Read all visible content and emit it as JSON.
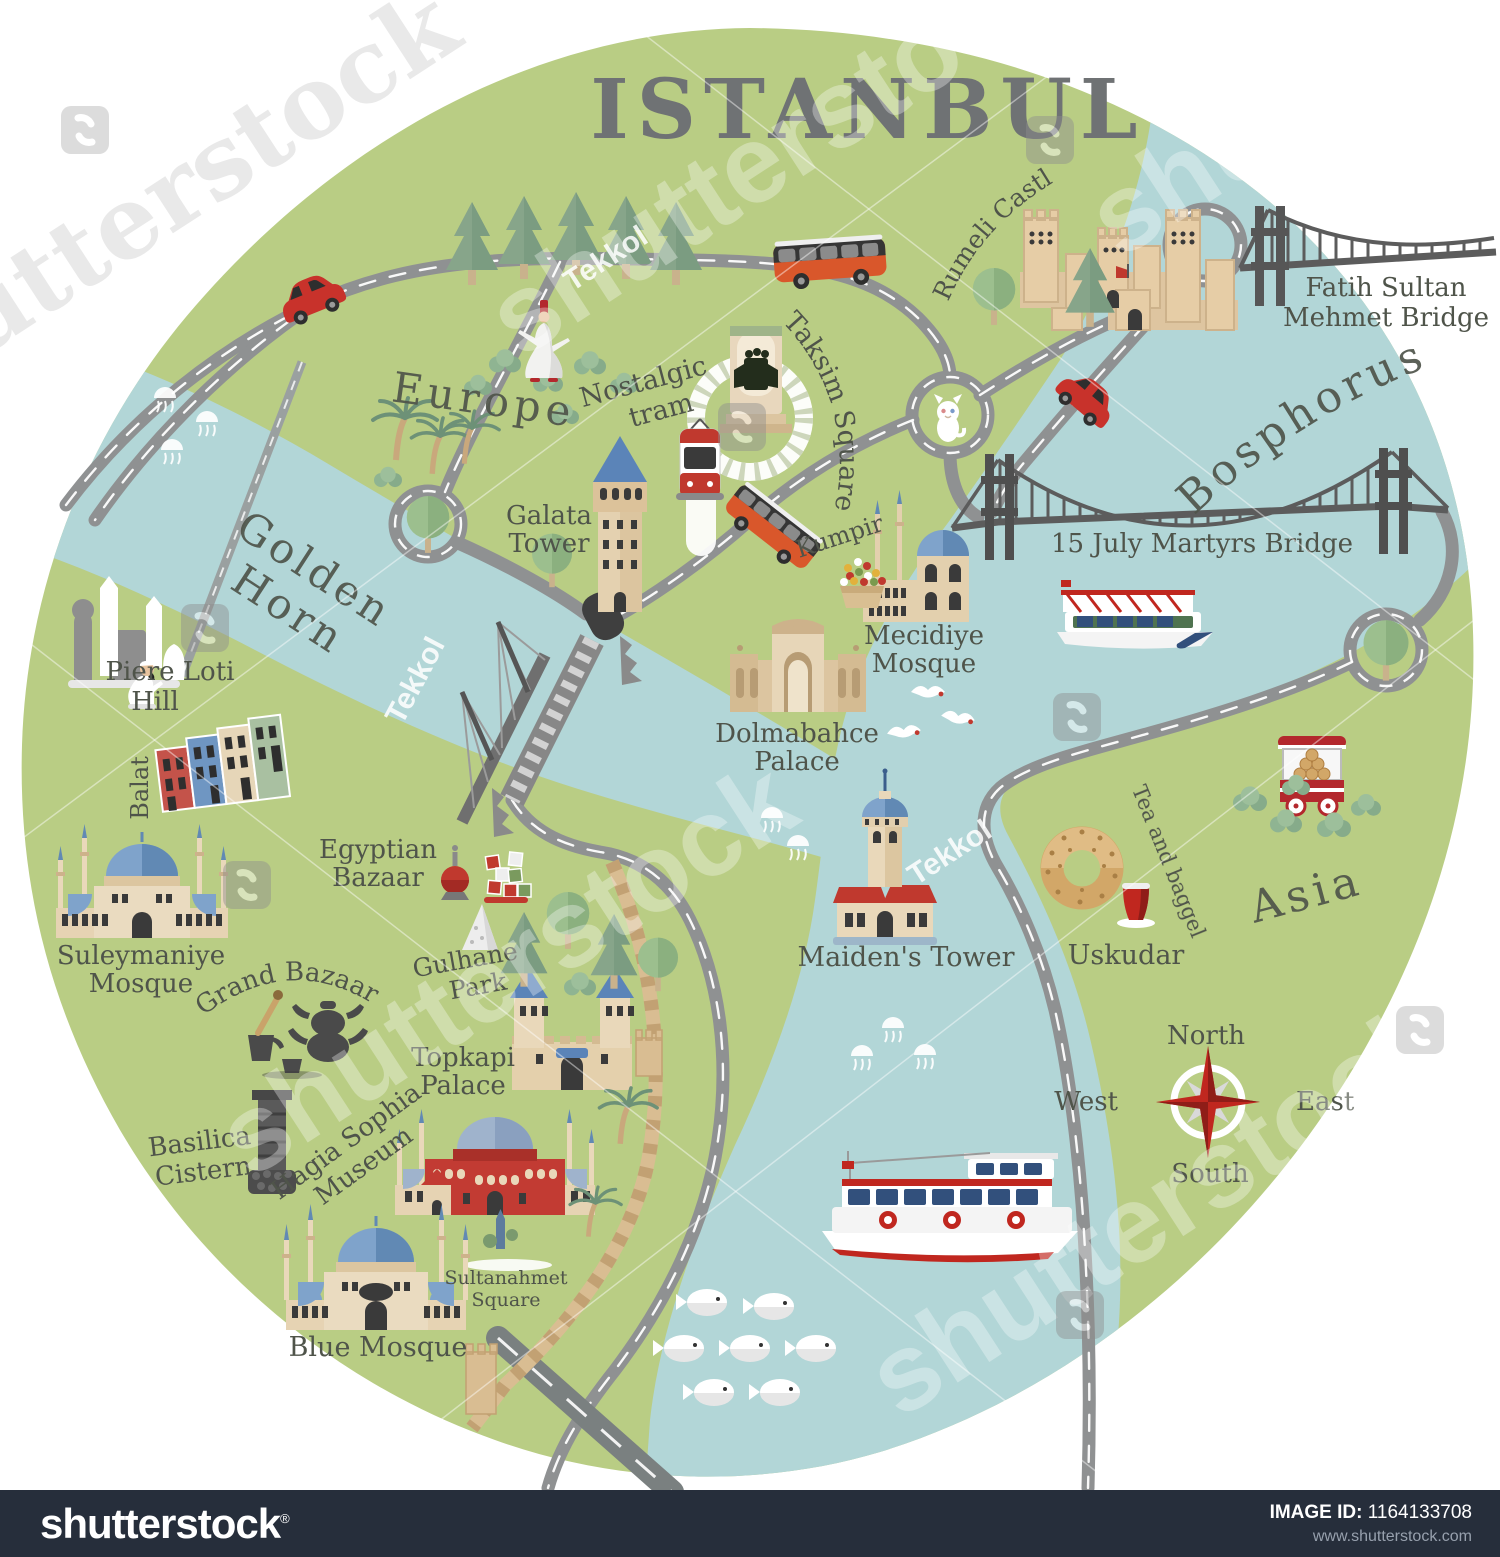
{
  "title": "ISTANBUL",
  "regions": {
    "europe": "Europe",
    "golden1": "Golden",
    "golden2": "Horn",
    "bosphorus": "Bosphorus",
    "asia": "Asia"
  },
  "landmarks": {
    "rumeli": "Rumeli Castle",
    "fsm1": "Fatih Sultan",
    "fsm2": "Mehmet Bridge",
    "martyrs": "15 July Martyrs Bridge",
    "taksim": "Taksim Square",
    "nostalgic1": "Nostalgic",
    "nostalgic2": "tram",
    "galata1": "Galata",
    "galata2": "Tower",
    "kumpir": "Kumpir",
    "mecidiye1": "Mecidiye",
    "mecidiye2": "Mosque",
    "dolma1": "Dolmabahce",
    "dolma2": "Palace",
    "piere1": "Piere Loti",
    "piere2": "Hill",
    "balat": "Balat",
    "egyptian1": "Egyptian",
    "egyptian2": "Bazaar",
    "suley1": "Suleymaniye",
    "suley2": "Mosque",
    "grandbazaar": "Grand Bazaar",
    "gulhane1": "Gulhane",
    "gulhane2": "Park",
    "topkapi1": "Topkapi",
    "topkapi2": "Palace",
    "basilica1": "Basilica",
    "basilica2": "Cistern",
    "hagia1": "Hagia Sophia",
    "hagia2": "Museum",
    "sultanahmet1": "Sultanahmet",
    "sultanahmet2": "Square",
    "bluemosque": "Blue Mosque",
    "maidens": "Maiden's Tower",
    "uskudar": "Uskudar",
    "teabaggel": "Tea and baggel"
  },
  "compass": {
    "north": "North",
    "west": "West",
    "east": "East",
    "south": "South"
  },
  "watermarks": {
    "brand": "shutterstock",
    "artist": "Tekkol"
  },
  "footer": {
    "logo": "shutterstock",
    "reg": "®",
    "id_label": "IMAGE ID:",
    "id_value": "1164133708",
    "website": "www.shutterstock.com"
  },
  "colors": {
    "land": "#b9cd84",
    "water": "#b2d6d7",
    "road": "#8f9192",
    "roaddark": "#7a8080",
    "label": "#4f544a",
    "title": "#6f7274",
    "red": "#c0392e",
    "domeblue": "#7fa3cb",
    "beige": "#e6d3b3",
    "walltan": "#d9bd92",
    "footerbg": "#262e3b"
  }
}
